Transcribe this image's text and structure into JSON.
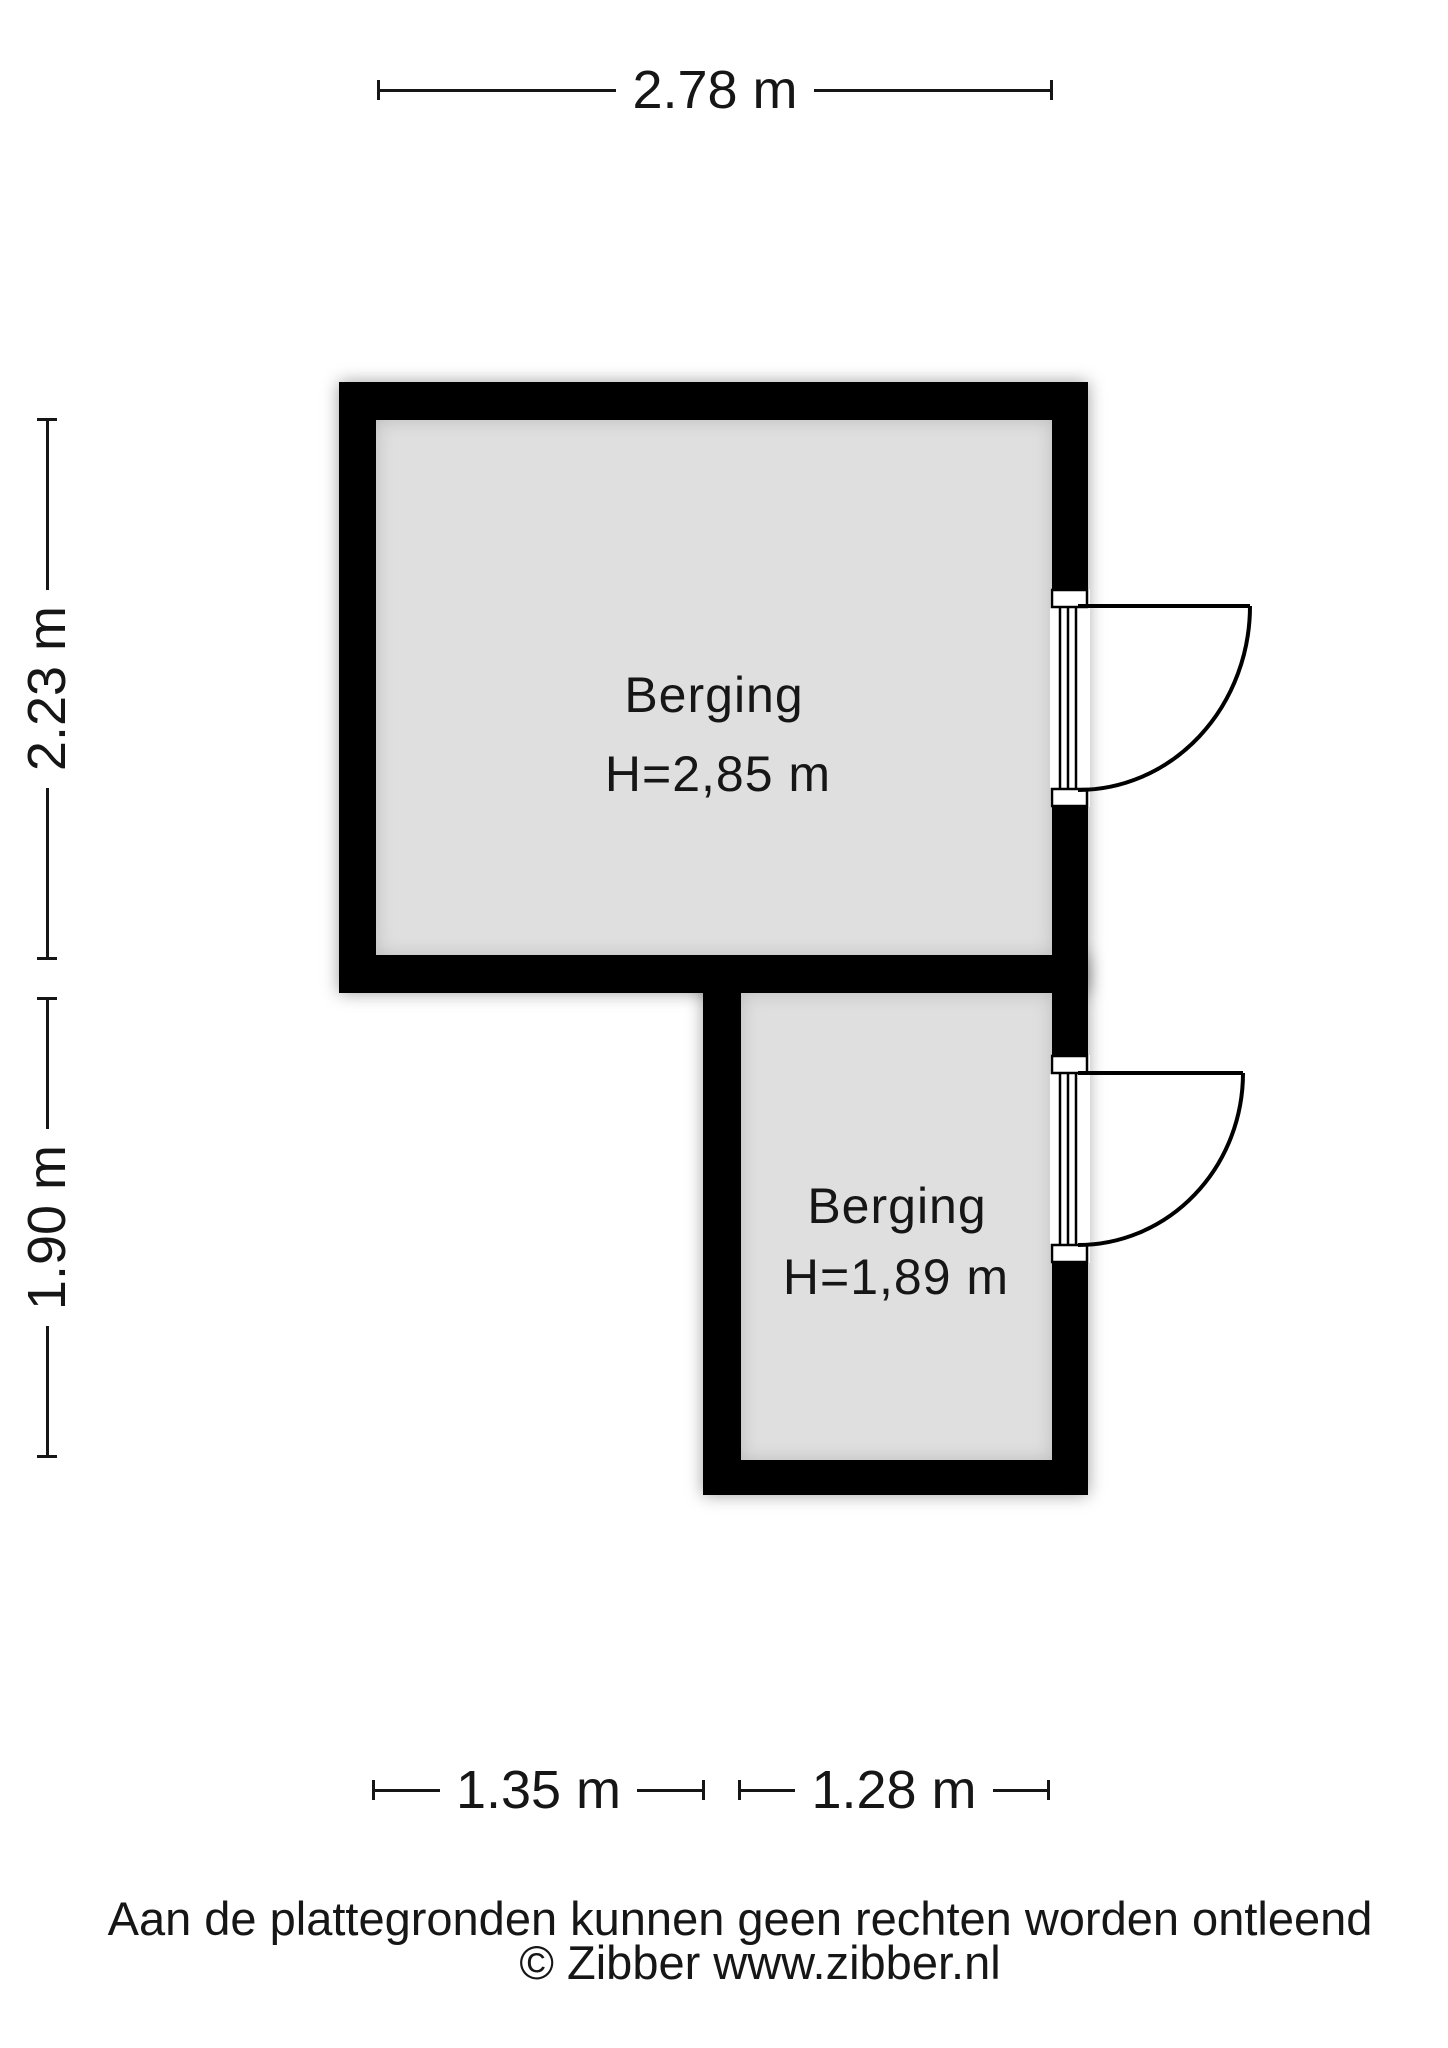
{
  "plan": {
    "rooms": [
      {
        "name": "Berging",
        "height_label": "H=2,85 m"
      },
      {
        "name": "Berging",
        "height_label": "H=1,89 m"
      }
    ],
    "dimensions": {
      "top": "2.78 m",
      "left_upper": "2.23 m",
      "left_lower": "1.90 m",
      "bottom_left": "1.35 m",
      "bottom_right": "1.28 m"
    },
    "colors": {
      "wall": "#000000",
      "floor": "#dfdfdf",
      "background": "#ffffff",
      "text": "#161616"
    }
  },
  "footer": {
    "disclaimer": "Aan de plattegronden kunnen geen rechten worden ontleend",
    "copyright": "© Zibber www.zibber.nl"
  }
}
